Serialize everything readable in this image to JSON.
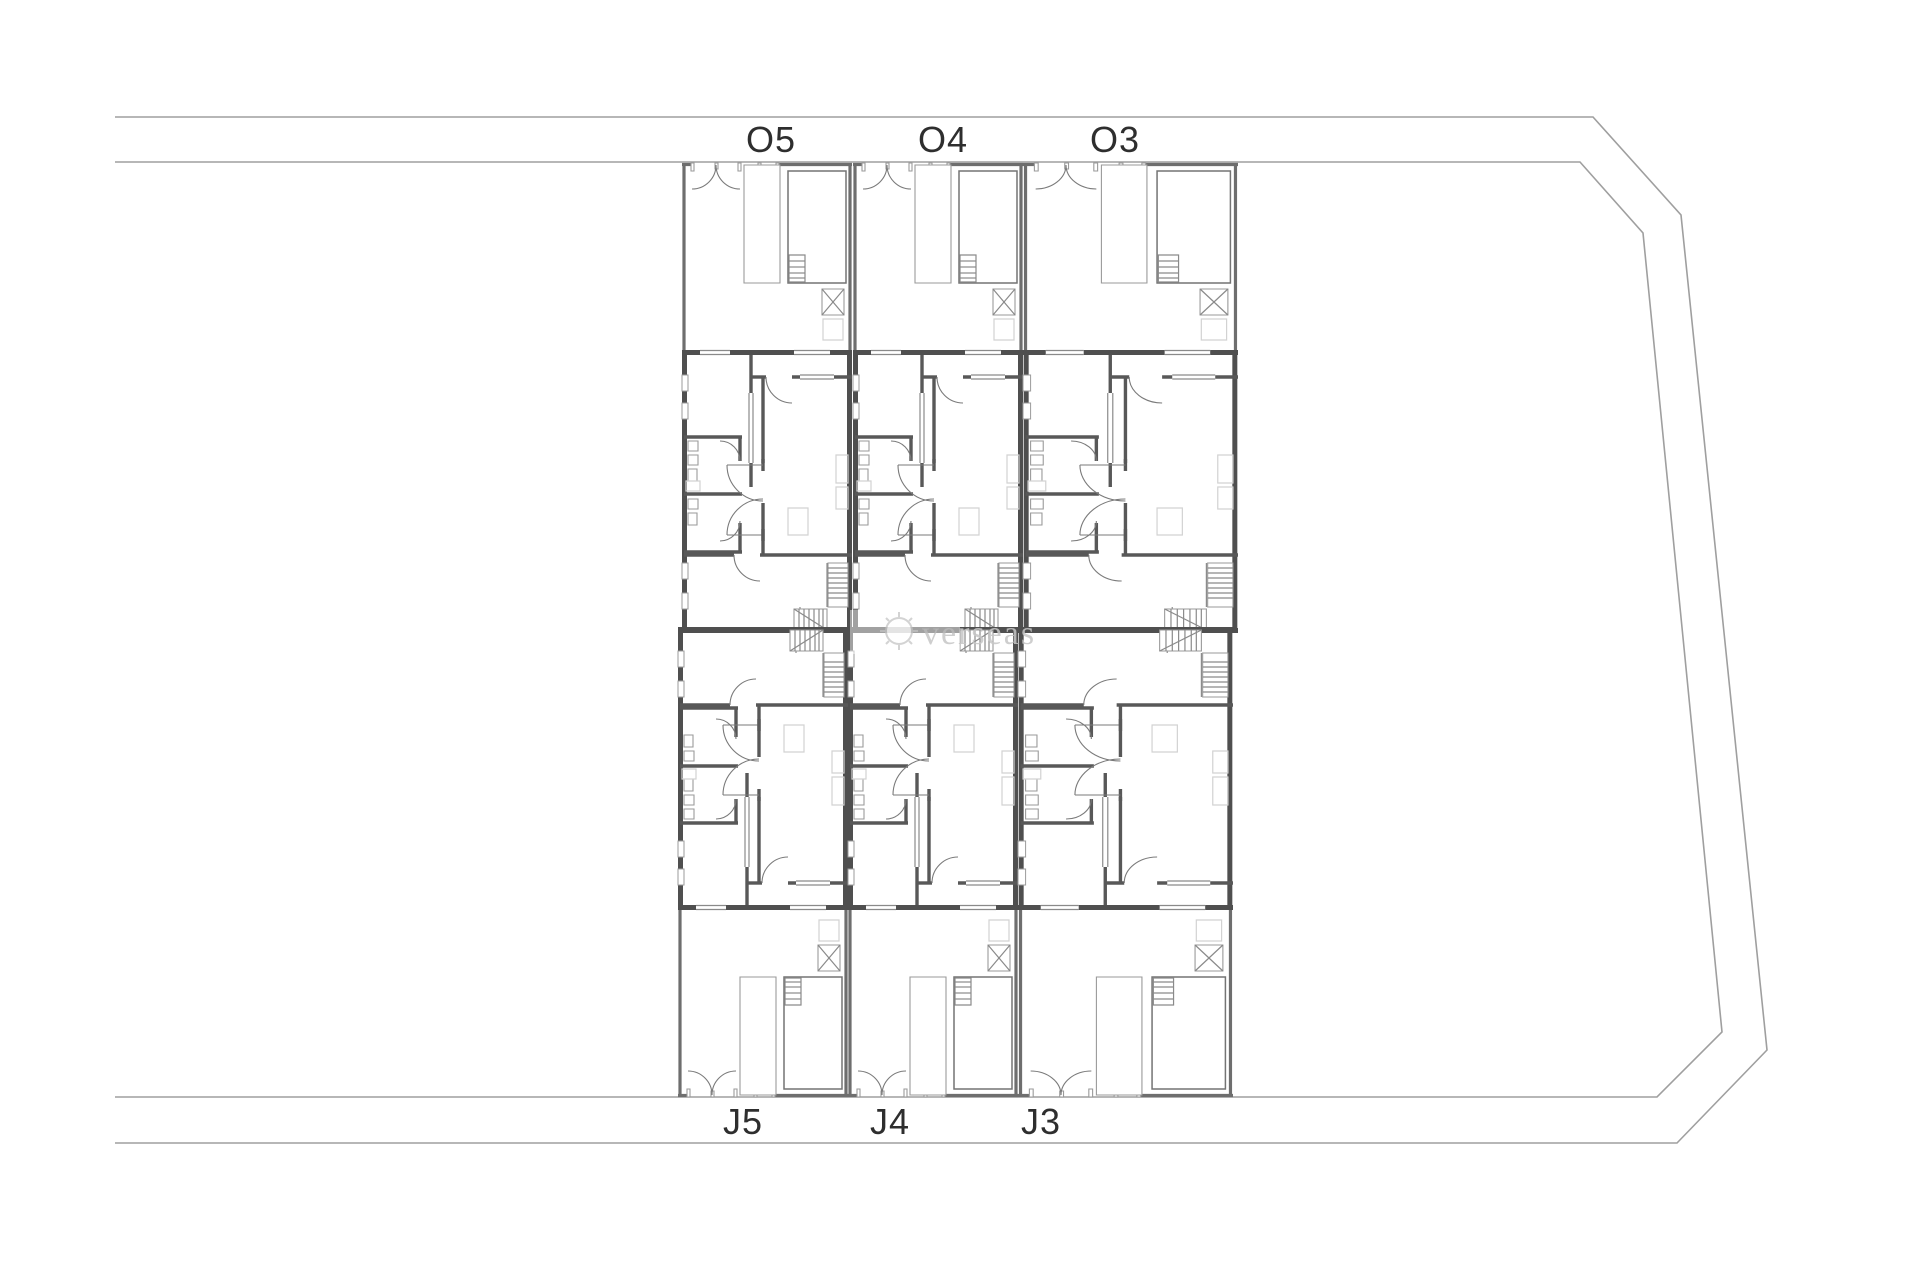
{
  "plan": {
    "units_top": [
      {
        "label": "O5"
      },
      {
        "label": "O4"
      },
      {
        "label": "O3"
      }
    ],
    "units_bottom": [
      {
        "label": "J5"
      },
      {
        "label": "J4"
      },
      {
        "label": "J3"
      }
    ],
    "watermark": {
      "text": "verseas",
      "icon": "sun-icon"
    },
    "colors": {
      "wall": "#4f4f4f",
      "interior_line": "#8a8a8a",
      "boundary": "#9f9f9f",
      "label": "#2e2e2e",
      "watermark": "#c6c6c6"
    }
  }
}
